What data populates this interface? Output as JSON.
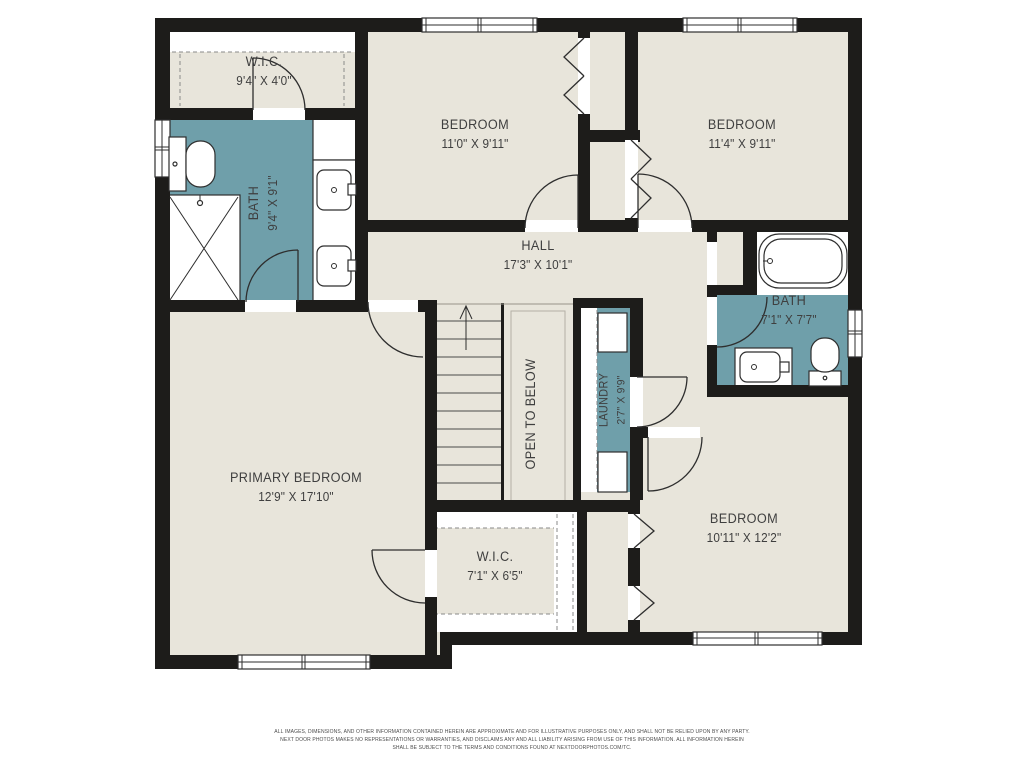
{
  "colors": {
    "floor": "#e8e5db",
    "wet": "#6f9faa",
    "wall": "#1d1c1a",
    "text": "#3f3f3f"
  },
  "rooms": [
    {
      "name": "W.I.C.",
      "dims": "9'4\" X 4'0\""
    },
    {
      "name": "BATH",
      "dims": "9'4\" X 9'1\""
    },
    {
      "name": "BEDROOM",
      "dims": "11'0\" X 9'11\""
    },
    {
      "name": "BEDROOM",
      "dims": "11'4\" X 9'11\""
    },
    {
      "name": "HALL",
      "dims": "17'3\" X 10'1\""
    },
    {
      "name": "BATH",
      "dims": "7'1\" X 7'7\""
    },
    {
      "name": "LAUNDRY",
      "dims": "2'7\" X 9'9\""
    },
    {
      "name": "OPEN TO BELOW",
      "dims": ""
    },
    {
      "name": "PRIMARY BEDROOM",
      "dims": "12'9\" X 17'10\""
    },
    {
      "name": "W.I.C.",
      "dims": "7'1\" X 6'5\""
    },
    {
      "name": "BEDROOM",
      "dims": "10'11\" X 12'2\""
    }
  ],
  "footer": {
    "line1": "ALL IMAGES, DIMENSIONS, AND OTHER INFORMATION CONTAINED HEREIN ARE APPROXIMATE AND FOR ILLUSTRATIVE PURPOSES ONLY, AND SHALL NOT BE RELIED UPON BY ANY PARTY.",
    "line2": "NEXT DOOR PHOTOS MAKES NO REPRESENTATIONS OR WARRANTIES, AND DISCLAIMS ANY AND ALL LIABILITY ARISING FROM USE OF THIS INFORMATION. ALL INFORMATION HEREIN",
    "line3": "SHALL BE SUBJECT TO THE TERMS AND CONDITIONS FOUND AT NEXTDOORPHOTOS.COM/TC."
  }
}
